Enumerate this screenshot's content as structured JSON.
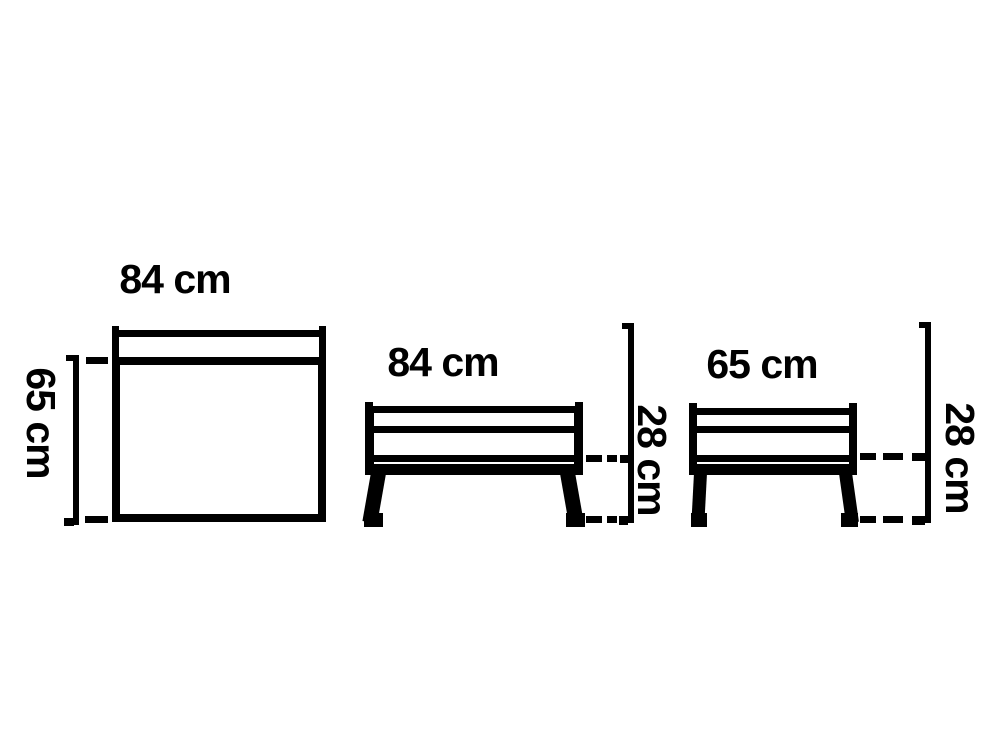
{
  "colors": {
    "ink": "#000000",
    "background": "#ffffff"
  },
  "dimensions": {
    "width_cm": 84,
    "depth_cm": 65,
    "seat_height_cm": 28
  },
  "views": {
    "top": {
      "width_label": "84 cm",
      "depth_label": "65 cm"
    },
    "front": {
      "width_label": "84 cm",
      "height_label": "28 cm"
    },
    "side": {
      "width_label": "65 cm",
      "height_label": "28 cm"
    }
  }
}
